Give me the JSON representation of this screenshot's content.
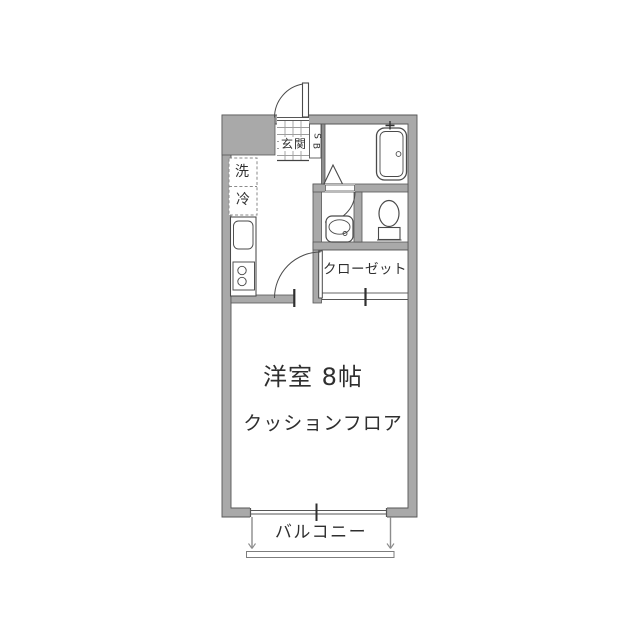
{
  "colors": {
    "wall_fill": "#a9a9a9",
    "wall_outline": "#565656",
    "fixture_line": "#4a4a4a",
    "tile_line": "#9e9e9e",
    "text": "#2f2f2f",
    "background": "#ffffff"
  },
  "plan": {
    "entrance": {
      "label": "玄関"
    },
    "shoe_box": {
      "letters": [
        "S",
        "B"
      ]
    },
    "kitchen": {
      "washer_label": "洗",
      "fridge_label": "冷"
    },
    "closet": {
      "label": "クローゼット"
    },
    "western_room": {
      "name_label": "洋室 8帖",
      "floor_label": "クッションフロア"
    },
    "balcony": {
      "label": "バルコニー"
    }
  }
}
